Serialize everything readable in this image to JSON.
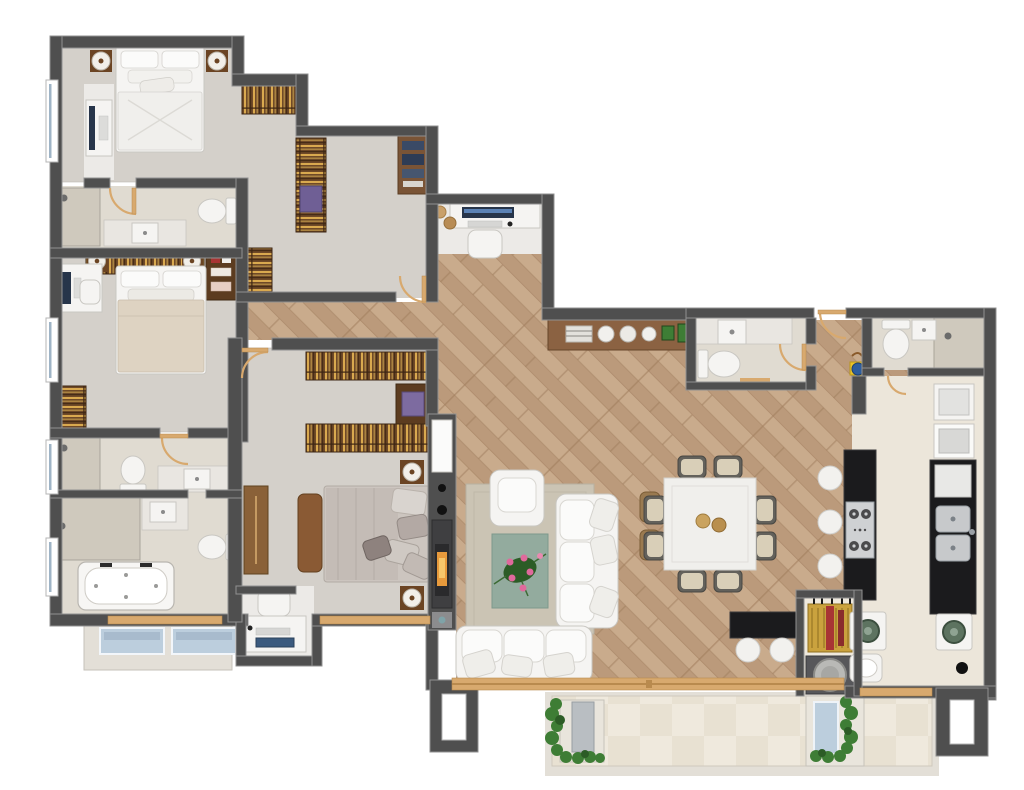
{
  "plan": {
    "type": "apartment-floor-plan",
    "view": "top-down-3d-render",
    "canvas": {
      "width": 1024,
      "height": 790
    },
    "rooms": [
      {
        "name": "bedroom-1",
        "floor": "carpet",
        "furniture": [
          "double-bed",
          "nightstand-lamp-left",
          "nightstand-lamp-right",
          "tv-cabinet",
          "window"
        ]
      },
      {
        "name": "walk-in-closet",
        "floor": "carpet",
        "furniture": [
          "shelf-unit-top",
          "shelf-unit-right",
          "storage-basket",
          "bookshelf"
        ]
      },
      {
        "name": "bathroom-1",
        "floor": "tile",
        "furniture": [
          "shower",
          "vanity-sink",
          "toilet"
        ]
      },
      {
        "name": "bedroom-2",
        "floor": "carpet",
        "furniture": [
          "double-bed",
          "desk-computer",
          "desk-chair",
          "wardrobe",
          "headboard-shelf",
          "lamp-left",
          "lamp-right",
          "shoe-cabinet",
          "window"
        ]
      },
      {
        "name": "bathroom-2",
        "floor": "tile",
        "furniture": [
          "shower",
          "toilet",
          "vanity-sink"
        ]
      },
      {
        "name": "master-bathroom",
        "floor": "tile",
        "furniture": [
          "walk-in-shower",
          "vanity-sink",
          "toilet",
          "bathtub",
          "window"
        ]
      },
      {
        "name": "bedroom-3",
        "floor": "carpet",
        "furniture": [
          "double-bed",
          "foot-bench",
          "shelf-unit-top",
          "shelf-unit-mid",
          "storage-cabinet",
          "wardrobe-door",
          "nightstand-lamp-top",
          "nightstand-lamp-bottom",
          "window"
        ]
      },
      {
        "name": "home-office-nook",
        "floor": "tile",
        "furniture": [
          "desk",
          "computer",
          "chair"
        ]
      },
      {
        "name": "entry-hall-office",
        "floor": "mixed",
        "furniture": [
          "desk",
          "monitor",
          "keyboard",
          "chair",
          "decor-vases",
          "bookshelf"
        ]
      },
      {
        "name": "living-room",
        "floor": "wood",
        "furniture": [
          "area-rug",
          "flower-coffee-table",
          "armchair",
          "sofa-right",
          "sofa-front",
          "side-tables",
          "media-fireplace-wall"
        ]
      },
      {
        "name": "dining-area",
        "floor": "wood",
        "furniture": [
          "square-dining-table",
          "dining-chairs-x8",
          "centerpiece-bowls"
        ]
      },
      {
        "name": "hall-console",
        "floor": "wood",
        "furniture": [
          "sideboard",
          "books",
          "decor-vases",
          "potted-plants"
        ]
      },
      {
        "name": "powder-room",
        "floor": "tile",
        "furniture": [
          "vanity-sink",
          "toilet",
          "door"
        ]
      },
      {
        "name": "kitchen",
        "floor": "tile",
        "furniture": [
          "island-counter",
          "cooktop",
          "bar-stools-x3",
          "sink-counter",
          "double-sink",
          "oven-stack"
        ]
      },
      {
        "name": "grill-bar",
        "floor": "wood",
        "furniture": [
          "bar-counter",
          "bar-stools-x2",
          "bbq-grill",
          "round-grill"
        ]
      },
      {
        "name": "service-bathroom",
        "floor": "tile",
        "furniture": [
          "toilet",
          "sink",
          "shower",
          "cleaning-caddy"
        ]
      },
      {
        "name": "laundry",
        "floor": "tile",
        "furniture": [
          "washing-machine",
          "dryer",
          "utility-sink",
          "floor-drain",
          "window"
        ]
      },
      {
        "name": "main-balcony",
        "floor": "tile-checker",
        "furniture": [
          "planter-left",
          "bench",
          "planter-right",
          "glass-panel",
          "plants"
        ]
      },
      {
        "name": "small-balcony",
        "floor": "slab",
        "furniture": [
          "glass-planter-1",
          "glass-planter-2"
        ]
      }
    ]
  },
  "palette": {
    "wall": "#4f4f4f",
    "wallEdge": "#919191",
    "carpet": "#d4d0ca",
    "carpetEdge": "#bdb9b2",
    "bathTile": "#e0dbd1",
    "bathTileDark": "#cfc9bd",
    "whiteFloor": "#eceae7",
    "woodA": "#c9ab8c",
    "woodB": "#bb9a7b",
    "woodLine": "#a07d5d",
    "balconyTile": "#efe9dd",
    "balconyTileAlt": "#e6dfd0",
    "slab": "#e3dfd7",
    "shelfWood": "#6f4a28",
    "shelfStripe": "#d9a94f",
    "shelfDark": "#3c2512",
    "furnWhite": "#f5f4f2",
    "furnEdge": "#c9c7c2",
    "bedBeige": "#ded3c2",
    "bedGray": "#b5aeaa",
    "counterDark": "#1b1b1d",
    "marble": "#e9e6e1",
    "steel": "#c7c9cb",
    "rugOuter": "#cbc4b4",
    "rugInner": "#93ab9e",
    "plant": "#3e7d35",
    "plantDark": "#2c5c26",
    "flower": "#e0699c",
    "glass": "#bccedd",
    "trimWood": "#d8a96e",
    "lampWood": "#6b4423",
    "amber": "#e79a3c",
    "ink": "#1a1a1a",
    "red": "#a83434",
    "yellow": "#e8c32a",
    "blue": "#2e5e9e"
  }
}
